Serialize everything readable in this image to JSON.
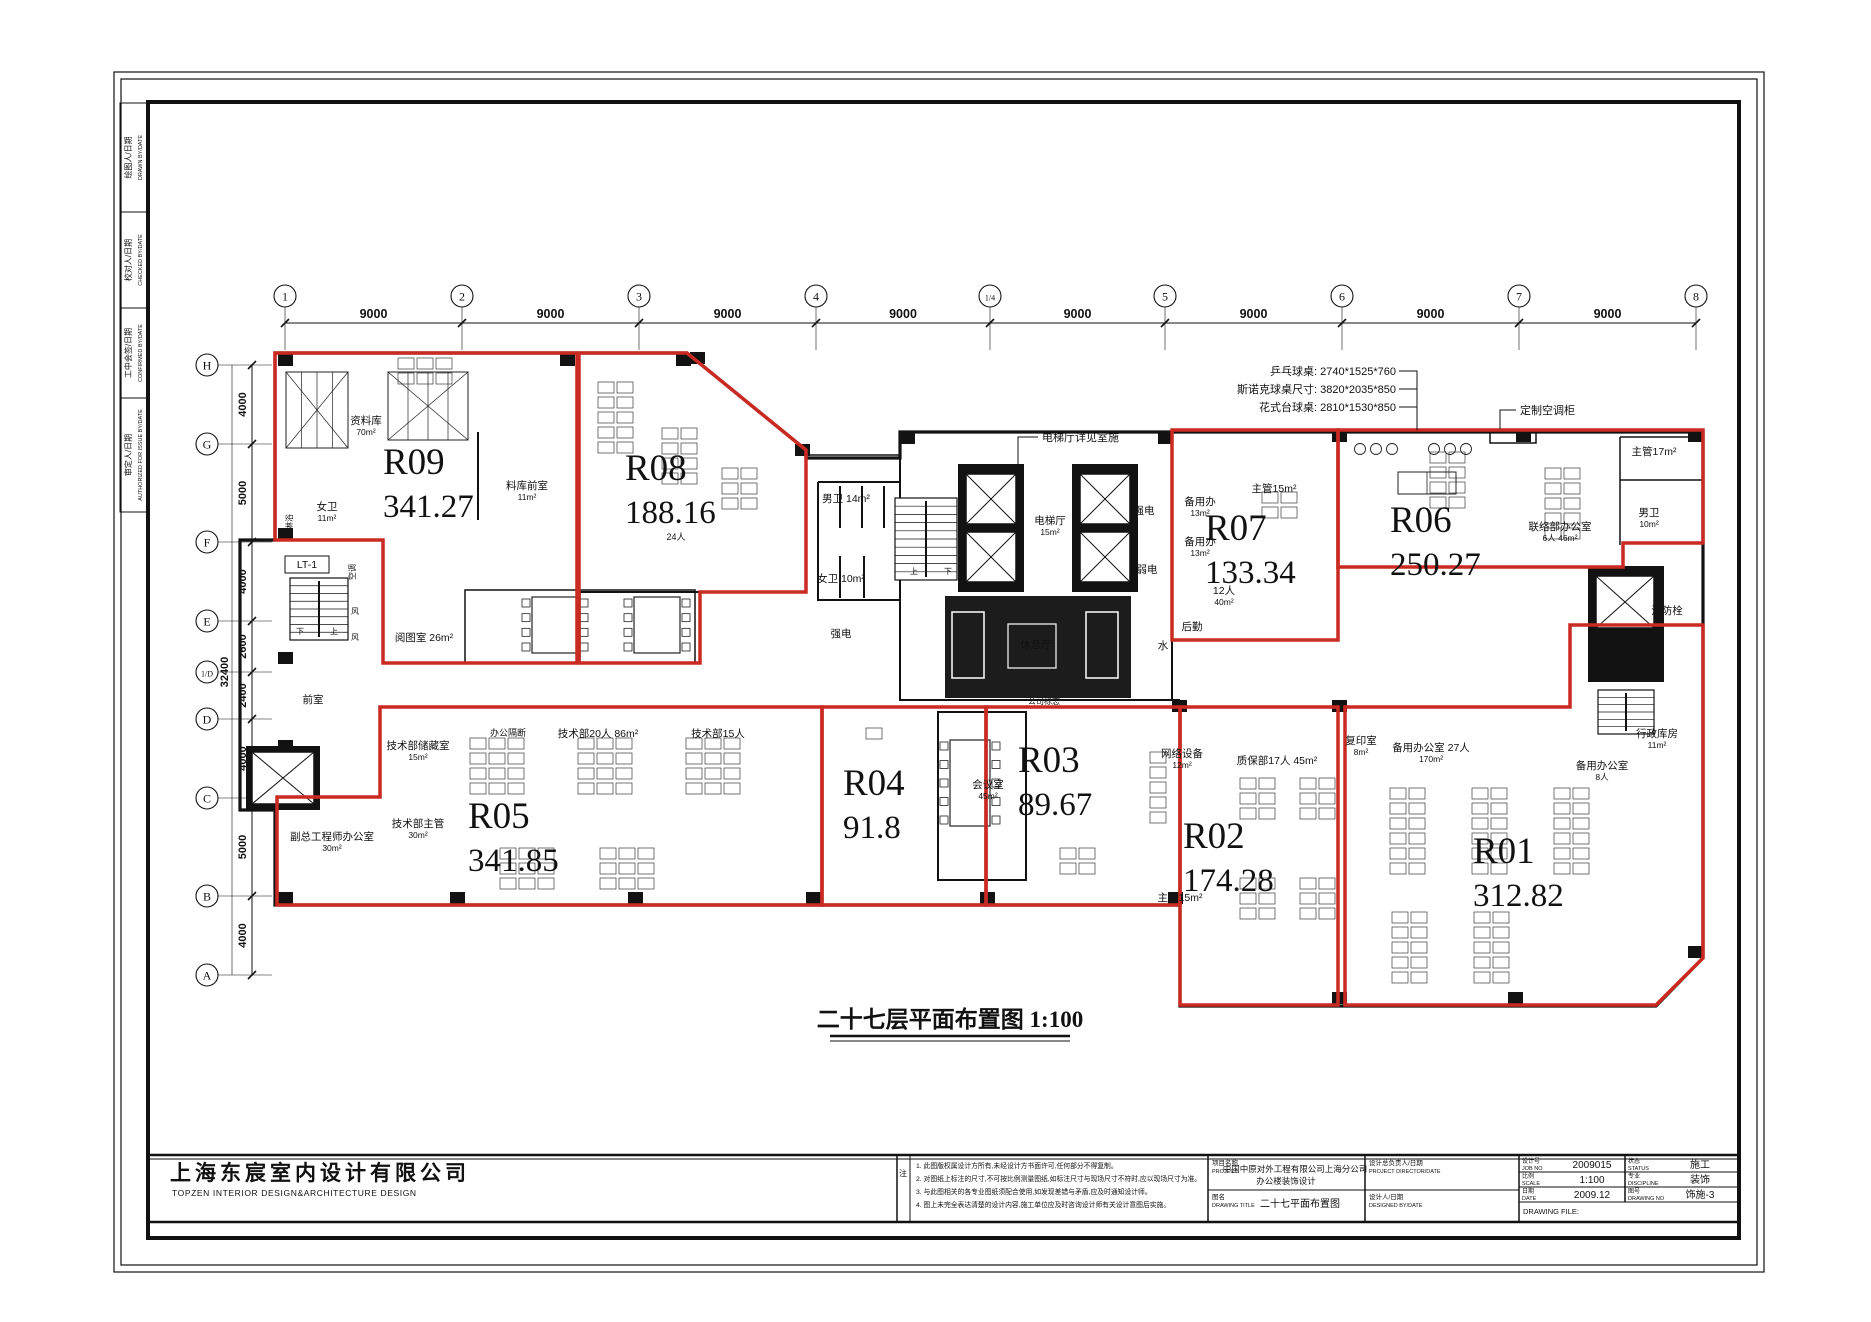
{
  "sheet": {
    "plan_title": "二十七层平面布置图 1:100",
    "company_cn": "上海东宸室内设计有限公司",
    "company_en": "TOPZEN INTERIOR DESIGN&ARCHITECTURE DESIGN"
  },
  "margin_labels": [
    {
      "cn": "绘图人/日期",
      "en": "DRAWN BY/DATE"
    },
    {
      "cn": "校对人/日期",
      "en": "CHECKED BY/DATE"
    },
    {
      "cn": "工中会签/日期",
      "en": "CONFIRMED BY/DATE"
    },
    {
      "cn": "审定人/日期",
      "en": "AUTHORIZED FOR ISSUE BY/DATE"
    }
  ],
  "grid": {
    "cols": [
      {
        "label": "1",
        "x": 285
      },
      {
        "label": "2",
        "x": 462
      },
      {
        "label": "3",
        "x": 639
      },
      {
        "label": "4",
        "x": 816
      },
      {
        "label": "1/4",
        "x": 990
      },
      {
        "label": "5",
        "x": 1165
      },
      {
        "label": "6",
        "x": 1342
      },
      {
        "label": "7",
        "x": 1519
      },
      {
        "label": "8",
        "x": 1696
      }
    ],
    "col_spans": [
      "9000",
      "9000",
      "9000",
      "9000",
      "9000",
      "9000",
      "9000",
      "9000"
    ],
    "rows": [
      {
        "label": "H",
        "y": 365
      },
      {
        "label": "G",
        "y": 444
      },
      {
        "label": "F",
        "y": 542
      },
      {
        "label": "E",
        "y": 621
      },
      {
        "label": "1/D",
        "y": 672
      },
      {
        "label": "D",
        "y": 719
      },
      {
        "label": "C",
        "y": 798
      },
      {
        "label": "B",
        "y": 896
      },
      {
        "label": "A",
        "y": 975
      }
    ],
    "row_spans": [
      "4000",
      "5000",
      "4000",
      "2600",
      "2400",
      "4000",
      "5000",
      "4000"
    ],
    "row_total": "32400"
  },
  "zones": [
    {
      "id": "R09",
      "area": "341.27",
      "pts": "275,353 577,353 577,663 383,663 383,540 275,540",
      "lx": 383,
      "ly": 474
    },
    {
      "id": "R08",
      "area": "188.16",
      "pts": "579,353 687,353 806,450 806,592 700,592 700,663 579,663",
      "lx": 625,
      "ly": 480
    },
    {
      "id": "R07",
      "area": "133.34",
      "pts": "1172,430 1338,430 1338,640 1172,640",
      "lx": 1205,
      "ly": 540
    },
    {
      "id": "R06",
      "area": "250.27",
      "pts": "1338,430 1703,430 1703,543 1623,543 1623,567 1338,567",
      "lx": 1390,
      "ly": 532
    },
    {
      "id": "R05",
      "area": "341.85",
      "pts": "380,707 822,707 822,905 277,905 277,797 380,797",
      "lx": 468,
      "ly": 828
    },
    {
      "id": "R04",
      "area": "91.8",
      "pts": "822,707 986,707 986,905 822,905",
      "lx": 843,
      "ly": 795
    },
    {
      "id": "R03",
      "area": "89.67",
      "pts": "986,707 1180,707 1180,905 986,905",
      "lx": 1018,
      "ly": 772
    },
    {
      "id": "R02",
      "area": "174.28",
      "pts": "1180,707 1338,707 1338,1005 1180,1005",
      "lx": 1183,
      "ly": 848
    },
    {
      "id": "R01",
      "area": "312.82",
      "pts": "1345,707 1570,707 1570,625 1703,625 1703,958 1656,1005 1345,1005",
      "lx": 1473,
      "ly": 863
    }
  ],
  "rooms": [
    {
      "t": "资料库",
      "s": "70m²",
      "x": 366,
      "y": 424
    },
    {
      "t": "料库前室",
      "s": "11m²",
      "x": 527,
      "y": 489
    },
    {
      "t": "女卫",
      "s": "11m²",
      "x": 327,
      "y": 510
    },
    {
      "t": "淋浴",
      "x": 292,
      "y": 522,
      "fs": 8,
      "rot": -90
    },
    {
      "t": "LT-1",
      "x": 307,
      "y": 568,
      "box": 1
    },
    {
      "t": "阅图室 26m²",
      "x": 424,
      "y": 641
    },
    {
      "t": "前室",
      "x": 313,
      "y": 703
    },
    {
      "t": "男卫 14m²",
      "x": 846,
      "y": 502
    },
    {
      "t": "女卫 10m²",
      "x": 841,
      "y": 582
    },
    {
      "t": "电梯厅",
      "s": "15m²",
      "x": 1050,
      "y": 524,
      "w": 1
    },
    {
      "t": "强电",
      "x": 1144,
      "y": 514
    },
    {
      "t": "弱电",
      "x": 1147,
      "y": 573
    },
    {
      "t": "水",
      "x": 1163,
      "y": 649
    },
    {
      "t": "休息厅",
      "x": 1036,
      "y": 648,
      "w": 1
    },
    {
      "t": "强电",
      "x": 841,
      "y": 637
    },
    {
      "t": "公司标志",
      "x": 1044,
      "y": 704,
      "fs": 8
    },
    {
      "t": "会议室",
      "s": "45m²",
      "x": 988,
      "y": 788
    },
    {
      "t": "网络设备",
      "s": "12m²",
      "x": 1182,
      "y": 757
    },
    {
      "t": "质保部17人 45m²",
      "x": 1277,
      "y": 764
    },
    {
      "t": "复印室",
      "s": "8m²",
      "x": 1361,
      "y": 744
    },
    {
      "t": "备用办公室 27人",
      "s": "170m²",
      "x": 1431,
      "y": 751
    },
    {
      "t": "行政库房",
      "s": "11m²",
      "x": 1657,
      "y": 737
    },
    {
      "t": "备用办公室",
      "s": "8人",
      "x": 1602,
      "y": 769
    },
    {
      "t": "主管15m²",
      "x": 1180,
      "y": 901
    },
    {
      "t": "技术部储藏室",
      "s": "15m²",
      "x": 418,
      "y": 749
    },
    {
      "t": "办公隔断",
      "x": 508,
      "y": 736,
      "fs": 9
    },
    {
      "t": "技术部20人 86m²",
      "x": 598,
      "y": 737
    },
    {
      "t": "技术部15人",
      "x": 718,
      "y": 737
    },
    {
      "t": "24人",
      "x": 676,
      "y": 540,
      "fs": 9
    },
    {
      "t": "技术部主管",
      "s": "30m²",
      "x": 418,
      "y": 827
    },
    {
      "t": "副总工程师办公室",
      "s": "30m²",
      "x": 332,
      "y": 840
    },
    {
      "t": "备用办",
      "s": "13m²",
      "x": 1200,
      "y": 505
    },
    {
      "t": "备用办",
      "s": "13m²",
      "x": 1200,
      "y": 545
    },
    {
      "t": "主管15m²",
      "x": 1274,
      "y": 492
    },
    {
      "t": "12人",
      "s": "40m²",
      "x": 1224,
      "y": 594
    },
    {
      "t": "后勤",
      "x": 1192,
      "y": 630
    },
    {
      "t": "联络部办公室",
      "s": "6人 46m²",
      "x": 1560,
      "y": 530
    },
    {
      "t": "主管17m²",
      "x": 1654,
      "y": 455
    },
    {
      "t": "男卫",
      "s": "10m²",
      "x": 1649,
      "y": 516
    },
    {
      "t": "消防栓",
      "x": 1667,
      "y": 614
    },
    {
      "t": "空调",
      "x": 355,
      "y": 572,
      "fs": 8,
      "rot": -90
    },
    {
      "t": "风",
      "x": 355,
      "y": 614,
      "fs": 8
    },
    {
      "t": "风",
      "x": 355,
      "y": 640,
      "fs": 8
    },
    {
      "t": "上",
      "x": 914,
      "y": 574,
      "fs": 8
    },
    {
      "t": "下",
      "x": 948,
      "y": 574,
      "fs": 8
    },
    {
      "t": "下",
      "x": 300,
      "y": 634,
      "fs": 8
    },
    {
      "t": "上",
      "x": 334,
      "y": 634,
      "fs": 8
    }
  ],
  "callouts": [
    {
      "t": "电梯厅详见室施",
      "x": 1042,
      "y": 441,
      "anchor": "start",
      "leader": "1038,437 1018,437 1018,492"
    },
    {
      "t": "定制空调柜",
      "x": 1520,
      "y": 414,
      "anchor": "start",
      "leader": "1516,410 1500,410 1500,429"
    },
    {
      "t": "乒乓球桌: 2740*1525*760",
      "x": 1396,
      "y": 375,
      "anchor": "end",
      "leader": "1399,371 1417,371 1417,430"
    },
    {
      "t": "斯诺克球桌尺寸: 3820*2035*850",
      "x": 1396,
      "y": 393,
      "anchor": "end",
      "leader": "1399,389 1417,389"
    },
    {
      "t": "花式台球桌: 2810*1530*850",
      "x": 1396,
      "y": 411,
      "anchor": "end",
      "leader": "1399,407 1417,407"
    }
  ],
  "titleblock": {
    "note_mark": "注",
    "notes": [
      "1. 此图版权属设计方所有,未经设计方书面许可,任何部分不得复制。",
      "2. 对图纸上标注的尺寸,不可按比例测量图纸,如标注尺寸与现场尺寸不符时,应以现场尺寸为准。",
      "3. 与此图相关的各专业图纸须配合使用,如发现差错与矛盾,应及时通知设计师。",
      "4. 图上未完全表达清楚的设计内容,施工单位应及时咨询设计师有关设计意图后实施。"
    ],
    "project_label_cn": "项目名称",
    "project_label_en": "PROJECT",
    "project_value_1": "中国中原对外工程有限公司上海分公司",
    "project_value_2": "办公楼装饰设计",
    "drawing_title_label_cn": "图名",
    "drawing_title_label_en": "DRAWING TITLE",
    "drawing_title_value": "二十七平面布置图",
    "director_label_cn": "设计总负责人/日期",
    "director_label_en": "PROJECT DIRECTOR/DATE",
    "designer_label_cn": "设计人/日期",
    "designer_label_en": "DESIGNED BY/DATE",
    "fields": [
      {
        "cn": "设计号",
        "en": "JOB NO",
        "v": "2009015"
      },
      {
        "cn": "比例",
        "en": "SCALE",
        "v": "1:100"
      },
      {
        "cn": "日期",
        "en": "DATE",
        "v": "2009.12"
      }
    ],
    "fields2": [
      {
        "cn": "状态",
        "en": "STATUS",
        "v": "施工"
      },
      {
        "cn": "专业",
        "en": "DISCIPLINE",
        "v": "装饰"
      },
      {
        "cn": "图号",
        "en": "DRAWING NO",
        "v": "饰施-3"
      }
    ],
    "drawing_file_label": "DRAWING FILE:"
  },
  "colors": {
    "zone_red": "#c92a22",
    "label_red": "#c2251f",
    "wall_black": "#121212"
  }
}
